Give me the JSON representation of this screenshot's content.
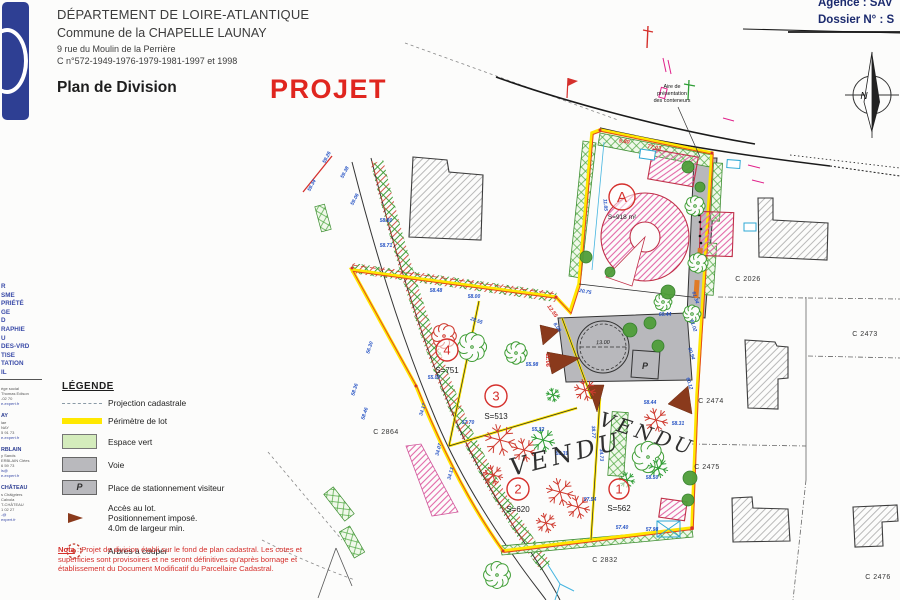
{
  "sidebar": {
    "logo": {
      "word_left": "GEOMETRES",
      "word_right": "EXPERTS"
    },
    "services": [
      "R",
      "SME",
      "PRIÉTÉ",
      "GE",
      "D",
      "RAPHIE",
      "U",
      "DES-VRD",
      "TISE",
      "TATION",
      "IL"
    ],
    "offices": [
      {
        "heading": "",
        "lines": [
          "ège social",
          "Thomas Edison",
          "-02 70",
          "e-expert.fr"
        ]
      },
      {
        "heading": "AY",
        "lines": [
          "lae",
          "NAY",
          "5 91 73",
          "e-expert.fr"
        ]
      },
      {
        "heading": "RBLAIN",
        "lines": [
          "y Sands",
          "ERBLAIN Clées",
          "6 59 73",
          "ls@",
          "e-expert.fr"
        ]
      },
      {
        "heading": "CHÂTEAU",
        "lines": [
          "s Châlgriers",
          "Calvola",
          "T-CHÂTEAU",
          "1 02 27",
          "-@",
          "expert.fr"
        ]
      }
    ]
  },
  "header": {
    "line1": "DÉPARTEMENT DE LOIRE-ATLANTIQUE",
    "line2": "Commune de la CHAPELLE LAUNAY",
    "line3": "9 rue du Moulin de la Perrière",
    "line4": "C n°572-1949-1976-1979-1981-1997 et 1998",
    "title": "Plan de Division",
    "stamp": "PROJET"
  },
  "topright": {
    "agence": "Agence : SAV",
    "dossier": "Dossier N° : S",
    "compass_letter": "N"
  },
  "legend": {
    "title": "LÉGENDE",
    "items": [
      {
        "label": "Projection cadastrale"
      },
      {
        "label": "Périmètre de lot"
      },
      {
        "label": "Espace vert"
      },
      {
        "label": "Voie"
      },
      {
        "label": "Place de stationnement visiteur"
      },
      {
        "label": "Accès au lot. Positionnement imposé. 4.0m de largeur min.",
        "lines": [
          "Accès au lot.",
          "Positionnement imposé.",
          "4.0m de largeur min."
        ]
      },
      {
        "label": "Arbres a couper"
      }
    ],
    "p_letter": "P"
  },
  "nota": {
    "label": "Nota",
    "text": " : Projet de division établi sur le fond de plan cadastral. Les cotes et superficies sont provisoires et ne seront définitives qu'après bornage et établissement du Document Modificatif du Parcellaire Cadastral."
  },
  "plan": {
    "parcels": [
      {
        "label": "C 2026",
        "x": 748,
        "y": 281
      },
      {
        "label": "C 2473",
        "x": 865,
        "y": 336
      },
      {
        "label": "C 2474",
        "x": 711,
        "y": 403
      },
      {
        "label": "C 2475",
        "x": 707,
        "y": 469
      },
      {
        "label": "C 2476",
        "x": 878,
        "y": 579
      },
      {
        "label": "C 2832",
        "x": 605,
        "y": 562
      },
      {
        "label": "C 2864",
        "x": 386,
        "y": 434
      }
    ],
    "lots": [
      {
        "id": "A",
        "area": "S=918 m²",
        "cx": 622,
        "cy": 197,
        "r": 13
      },
      {
        "id": "4",
        "area": "S=751",
        "cx": 447,
        "cy": 350,
        "r": 11
      },
      {
        "id": "3",
        "area": "S=513",
        "cx": 496,
        "cy": 396,
        "r": 11
      },
      {
        "id": "2",
        "area": "S=620",
        "cx": 518,
        "cy": 489,
        "r": 11
      },
      {
        "id": "1",
        "area": "S=562",
        "cx": 619,
        "cy": 489,
        "r": 10
      }
    ],
    "vendu": [
      {
        "text": "VENDU",
        "x": 512,
        "y": 476,
        "rot": -14,
        "size": 24
      },
      {
        "text": "VENDU",
        "x": 598,
        "y": 425,
        "rot": 18,
        "size": 20
      }
    ],
    "annotation": {
      "lines": [
        "Aire de",
        "présentation",
        "des conteneurs"
      ]
    },
    "voie": {
      "circle_label": "13.00",
      "parking": "P"
    },
    "dims_blue": [
      [
        "59.26",
        328,
        158,
        -62
      ],
      [
        "59.34",
        313,
        186,
        -62
      ],
      [
        "59.38",
        346,
        173,
        -62
      ],
      [
        "59.06",
        356,
        200,
        -62
      ],
      [
        "58.80",
        386,
        222,
        0
      ],
      [
        "58.71",
        386,
        247,
        0
      ],
      [
        "58.48",
        436,
        292,
        0
      ],
      [
        "58.00",
        474,
        298,
        0
      ],
      [
        "56.30",
        371,
        348,
        -72
      ],
      [
        "58.36",
        356,
        390,
        -72
      ],
      [
        "58.46",
        366,
        414,
        -72
      ],
      [
        "34.17",
        424,
        410,
        -73
      ],
      [
        "34.07",
        440,
        450,
        -75
      ],
      [
        "34.13",
        452,
        474,
        -75
      ],
      [
        "28.55",
        476,
        322,
        20
      ],
      [
        "55.98",
        532,
        366,
        0
      ],
      [
        "55.00",
        434,
        379,
        0
      ],
      [
        "57.70",
        468,
        424,
        0
      ],
      [
        "55.32",
        538,
        431,
        0
      ],
      [
        "55.39",
        562,
        455,
        0
      ],
      [
        "20.75",
        585,
        293,
        10
      ],
      [
        "11.85",
        604,
        205,
        85
      ],
      [
        "58.44",
        650,
        404,
        0
      ],
      [
        "58.31",
        678,
        425,
        0
      ],
      [
        "38.77",
        592,
        432,
        88
      ],
      [
        "34.73",
        600,
        455,
        88
      ],
      [
        "57.54",
        590,
        501,
        0
      ],
      [
        "58.50",
        652,
        479,
        0
      ],
      [
        "57.40",
        622,
        529,
        0
      ],
      [
        "57.98",
        652,
        531,
        0
      ],
      [
        "61.34",
        694,
        298,
        72
      ],
      [
        "61.02",
        692,
        326,
        72
      ],
      [
        "60.94",
        690,
        354,
        72
      ],
      [
        "60.12",
        688,
        384,
        72
      ],
      [
        "8.00",
        556,
        328,
        55
      ],
      [
        "60.44",
        665,
        316,
        0
      ]
    ],
    "dims_red": [
      [
        "77.03",
        654,
        149,
        9
      ],
      [
        "5.80",
        624,
        143,
        8
      ],
      [
        "11.06",
        546,
        360,
        90
      ],
      [
        "12.55",
        551,
        312,
        55
      ]
    ],
    "trees": {
      "flower_green": [
        [
          472,
          347,
          13
        ],
        [
          516,
          353,
          10
        ],
        [
          648,
          457,
          14
        ],
        [
          695,
          206,
          9
        ],
        [
          698,
          263,
          9
        ],
        [
          692,
          314,
          8
        ],
        [
          497,
          575,
          12
        ],
        [
          663,
          302,
          8
        ]
      ],
      "flower_red": [
        [
          444,
          336,
          11
        ]
      ],
      "snow_red": [
        [
          500,
          440,
          16
        ],
        [
          524,
          450,
          12
        ],
        [
          560,
          492,
          14
        ],
        [
          578,
          507,
          12
        ],
        [
          546,
          523,
          10
        ],
        [
          656,
          420,
          12
        ],
        [
          585,
          390,
          11
        ],
        [
          493,
          475,
          10
        ]
      ],
      "snow_green": [
        [
          543,
          440,
          12
        ],
        [
          658,
          468,
          10
        ],
        [
          553,
          395,
          7
        ],
        [
          627,
          480,
          8
        ]
      ],
      "blobs": [
        [
          688,
          167,
          6
        ],
        [
          700,
          187,
          5
        ],
        [
          630,
          330,
          7
        ],
        [
          650,
          323,
          6
        ],
        [
          658,
          346,
          6
        ],
        [
          690,
          478,
          7
        ],
        [
          688,
          500,
          6
        ],
        [
          586,
          257,
          6
        ],
        [
          610,
          272,
          5
        ],
        [
          668,
          292,
          7
        ]
      ]
    }
  }
}
